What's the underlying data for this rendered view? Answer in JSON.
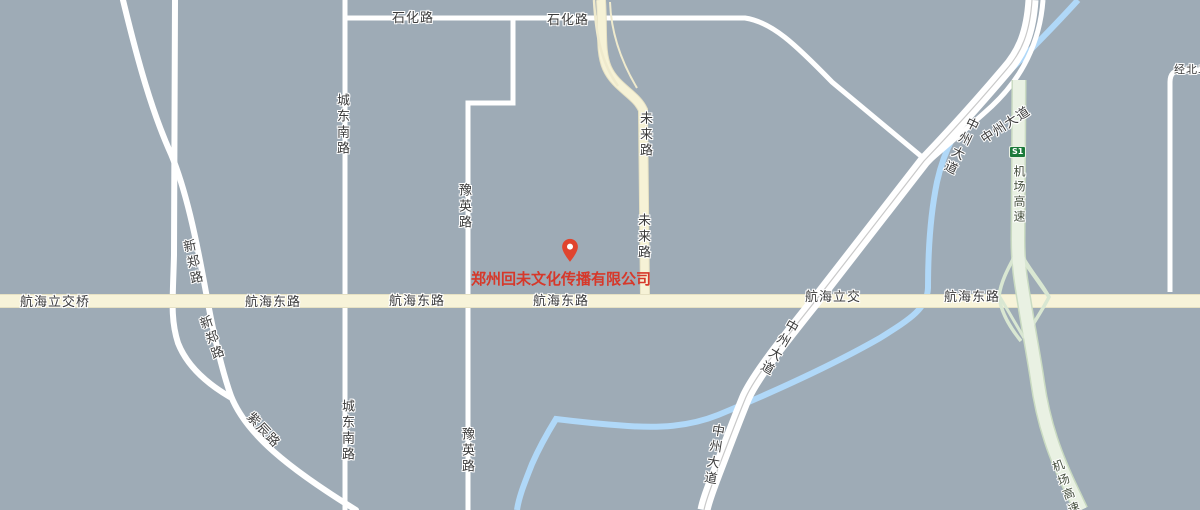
{
  "map": {
    "company_label": {
      "text": "郑州回未文化传播有限公司",
      "color": "#d6382a"
    },
    "marker": {
      "icon": "location-pin",
      "color": "#e0442e"
    },
    "road_labels": {
      "shihua_1": "石化路",
      "shihua_2": "石化路",
      "chengdongnan_1": "城东南路",
      "chengdongnan_2": "城东南路",
      "yuying_1": "豫英路",
      "yuying_2": "豫英路",
      "weilai_1": "未来路",
      "weilai_2": "未来路",
      "xinzheng_1": "新郑路",
      "xinzheng_2": "新郑路",
      "zichen": "紫辰路",
      "hanghai_lijiaoqiao": "航海立交桥",
      "hanghai_1": "航海东路",
      "hanghai_2": "航海东路",
      "hanghai_3": "航海东路",
      "hanghai_lijiao": "航海立交",
      "hanghai_4": "航海东路",
      "zhongzhou_1": "中州大道",
      "zhongzhou_2": "中州大道",
      "zhongzhou_3": "中州大道",
      "zhongzhou_4": "中州大道",
      "jichang_gaosu_1": "机场高速",
      "jichang_gaosu_2": "机场高速",
      "jingbei": "经北二",
      "s1_badge": "S1"
    },
    "colors": {
      "background": "#9eabb6",
      "minor_road": "#ffffff",
      "arterial_road_fill": "#f7f3d9",
      "arterial_road_casing": "#e6e1c3",
      "highway_fill": "#e9f1e3",
      "highway_casing": "#cadbc2",
      "river": "#b0d8f8",
      "badge_green": "#1b7a3a",
      "label_text": "#3c3c3c"
    }
  }
}
